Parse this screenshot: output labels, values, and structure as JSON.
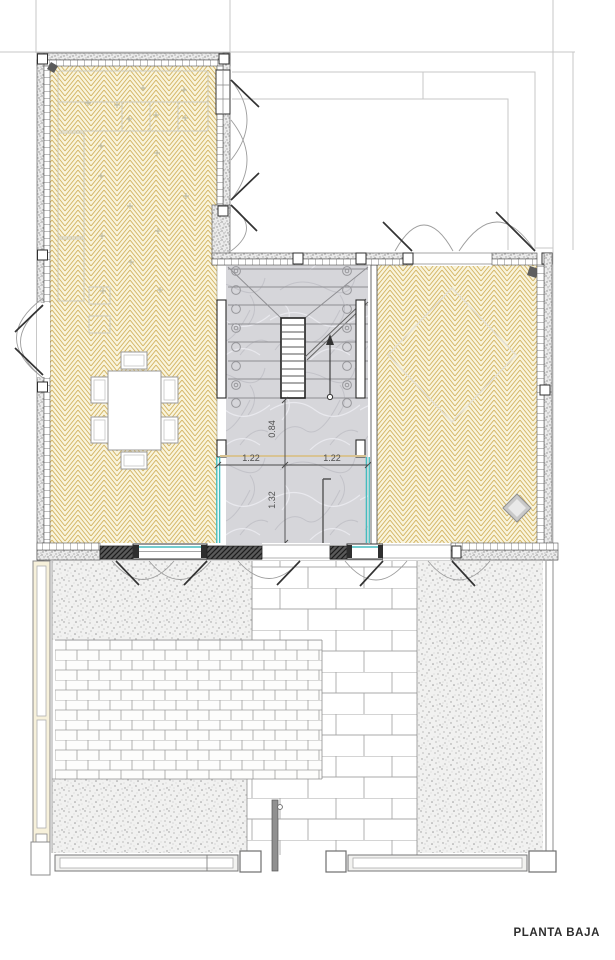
{
  "title": {
    "label": "PLANTA BAJA"
  },
  "plan": {
    "dimensions": {
      "hall_width_left": "1.22",
      "hall_width_right": "1.22",
      "landing_depth": "0.84",
      "vestibule_depth": "1.32"
    }
  },
  "colors": {
    "wood_floor_line": "#d3b463",
    "wood_floor_bg": "#f9f4dc",
    "marble_bg": "#d6d6da",
    "marble_vein": "#c3c3c9",
    "glass_accent": "#45bcbe",
    "wall_fill": "#8b8b8b",
    "site_line": "#c7c7c7",
    "dim_text": "#4e4e4e",
    "title_text": "#2d2d2d"
  }
}
